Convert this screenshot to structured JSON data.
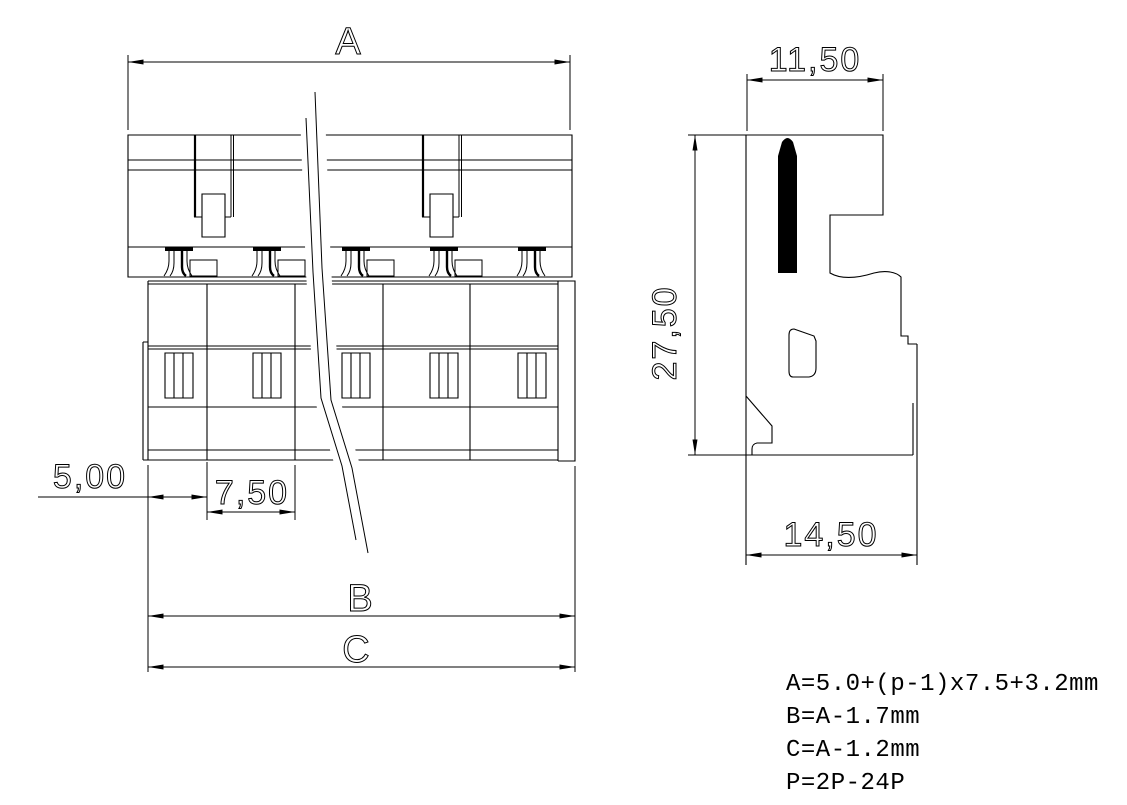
{
  "drawing": {
    "front_view": {
      "dim_overall_top": "A",
      "dim_overall_b": "B",
      "dim_overall_c": "C",
      "dim_first_pitch": "5,00",
      "dim_pitch": "7,50"
    },
    "side_view": {
      "dim_top_width": "11,50",
      "dim_height": "27,50",
      "dim_bottom_width": "14,50"
    },
    "formulas": {
      "line1": "A=5.0+(p-1)x7.5+3.2mm",
      "line2": "B=A-1.7mm",
      "line3": "C=A-1.2mm",
      "line4": "P=2P-24P"
    },
    "colors": {
      "line": "#000000",
      "background": "#ffffff",
      "pin_fill": "#000000"
    }
  }
}
